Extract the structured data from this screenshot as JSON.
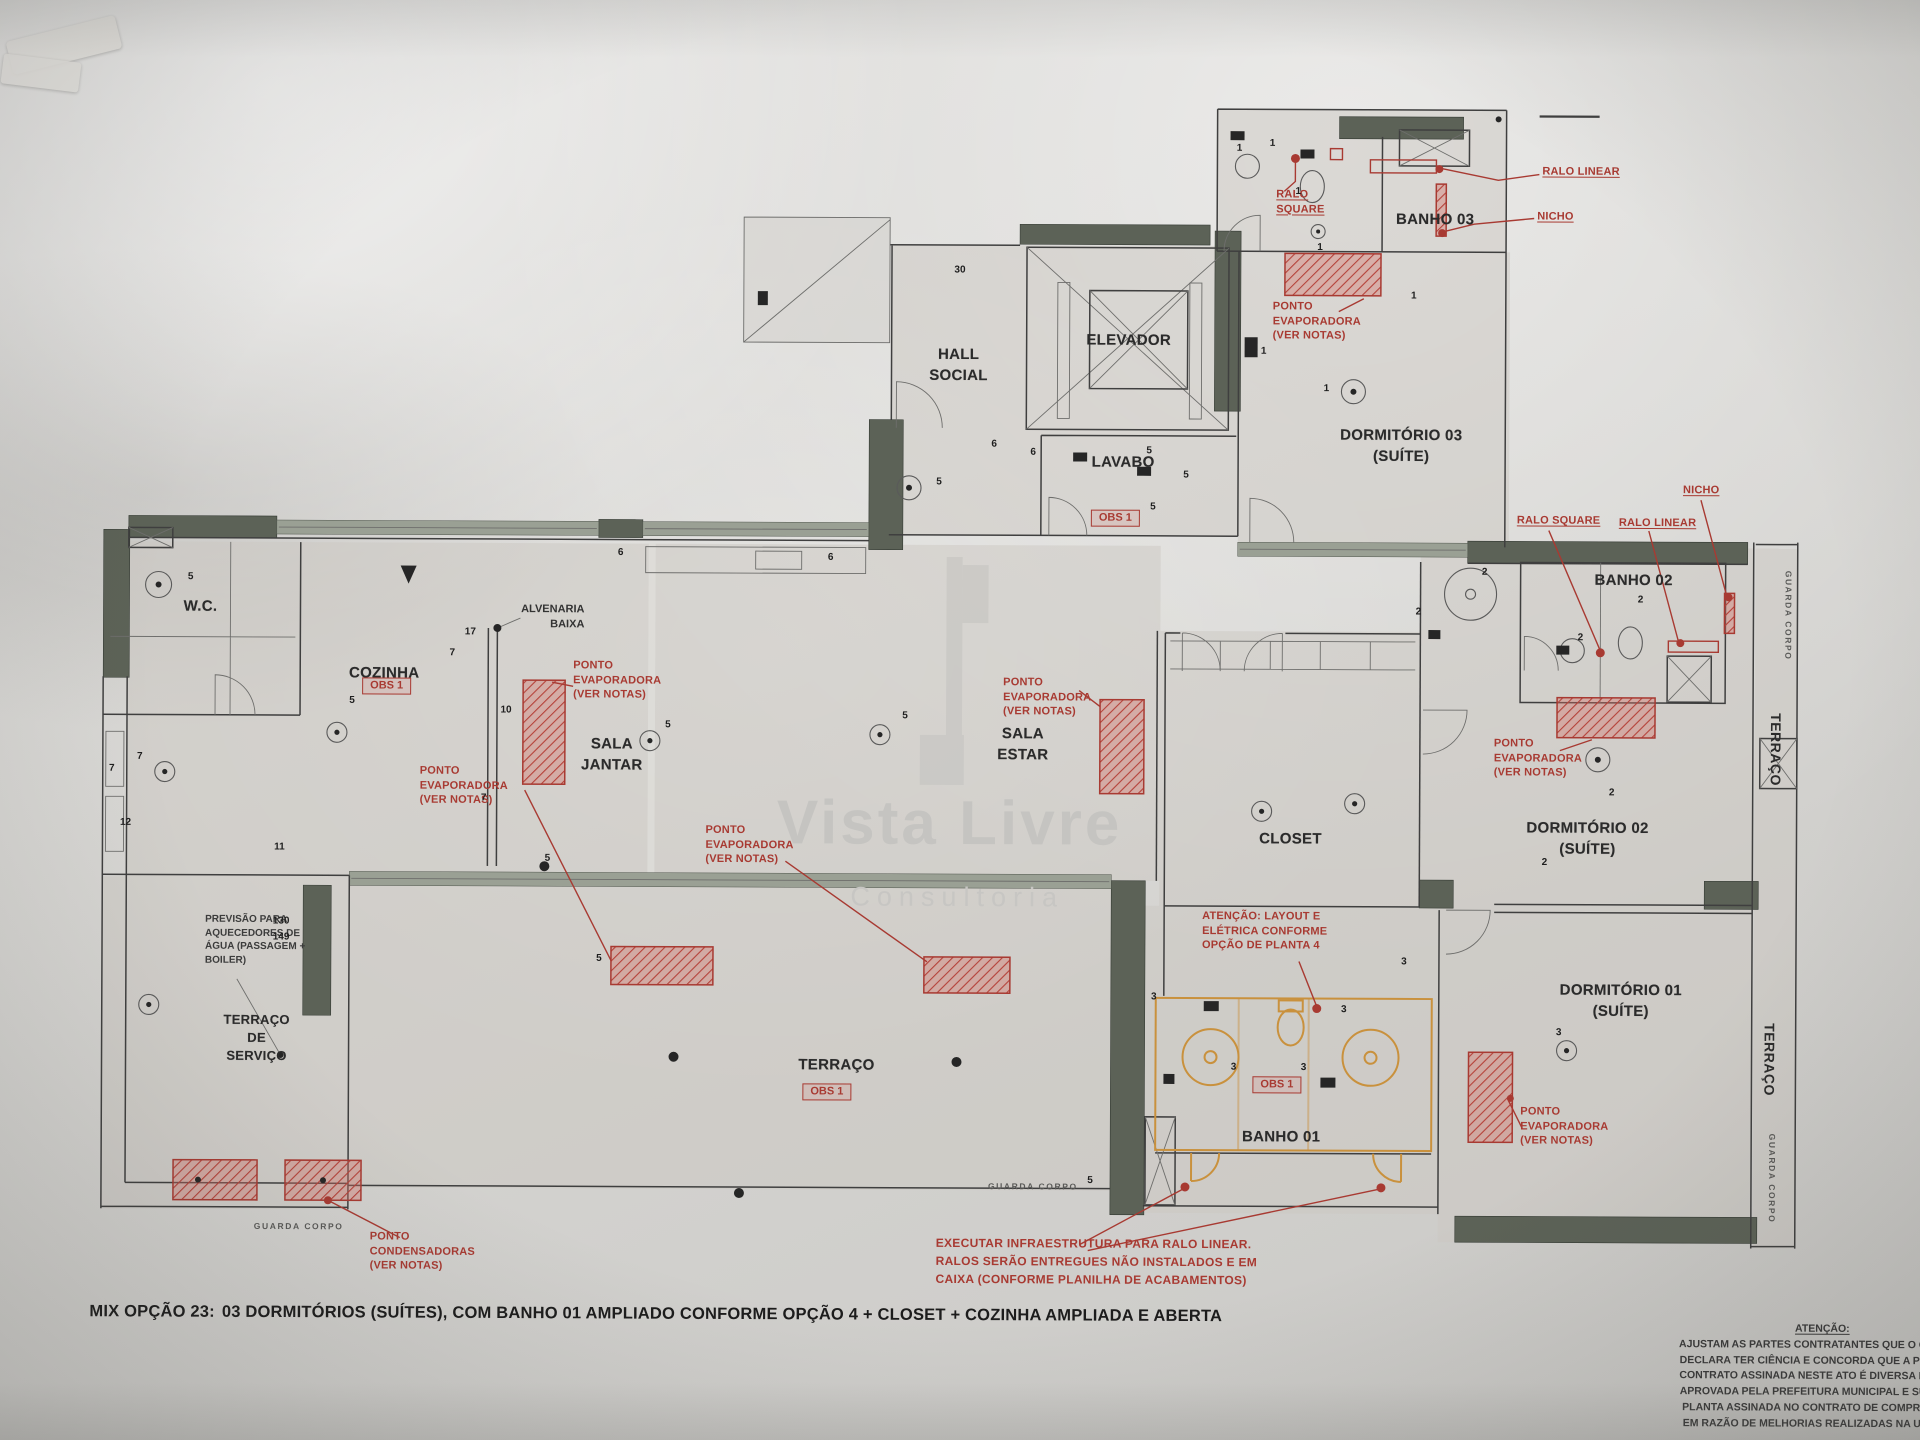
{
  "watermark": {
    "title": "Vista Livre",
    "subtitle": "Consultoria"
  },
  "rooms": {
    "elevador": "ELEVADOR",
    "hall_social": "HALL\nSOCIAL",
    "lavabo": "LAVABO",
    "banho03": "BANHO 03",
    "dormitorio03": "DORMITÓRIO 03\n(SUÍTE)",
    "banho02": "BANHO 02",
    "dormitorio02": "DORMITÓRIO 02\n(SUÍTE)",
    "closet": "CLOSET",
    "sala_estar": "SALA\nESTAR",
    "sala_jantar": "SALA\nJANTAR",
    "cozinha": "COZINHA",
    "wc": "W.C.",
    "terraco_servico": "TERRAÇO\nDE\nSERVIÇO",
    "terraco": "TERRAÇO",
    "banho01": "BANHO 01",
    "dormitorio01": "DORMITÓRIO 01\n(SUÍTE)",
    "terraco_lateral_superior": "TERRAÇO",
    "terraco_lateral_inferior": "TERRAÇO"
  },
  "annotations": {
    "ralo_linear": "RALO LINEAR",
    "nicho": "NICHO",
    "ralo_square": "RALO\nSQUARE",
    "ralo_square_inline": "RALO SQUARE",
    "ponto_evaporadora": "PONTO\nEVAPORADORA\n(VER NOTAS)",
    "ponto_condensadoras": "PONTO\nCONDENSADORAS\n(VER NOTAS)",
    "obs1": "OBS 1",
    "alvenaria_baixa": "ALVENARIA\nBAIXA",
    "previsao": "PREVISÃO PARA\nAQUECEDORES DE\nÁGUA (PASSAGEM +\nBOILER)",
    "atencao_layout": "ATENÇÃO: LAYOUT E\nELÉTRICA CONFORME\nOPÇÃO DE PLANTA 4",
    "executar_ralo": "EXECUTAR INFRAESTRUTURA PARA RALO LINEAR.\nRALOS SERÃO ENTREGUES NÃO INSTALADOS E EM\nCAIXA (CONFORME PLANILHA DE ACABAMENTOS)",
    "guarda_corpo": "GUARDA CORPO"
  },
  "caption": {
    "prefix": "MIX OPÇÃO 23:",
    "text": "03 DORMITÓRIOS (SUÍTES), COM BANHO 01 AMPLIADO CONFORME OPÇÃO 4 + CLOSET + COZINHA AMPLIADA E ABERTA"
  },
  "legal": {
    "title": "ATENÇÃO:",
    "lines": [
      "AJUSTAM AS PARTES CONTRATANTES QUE O COMPRA",
      "DECLARA TER CIÊNCIA E CONCORDA QUE A PLANTA D",
      "CONTRATO ASSINADA NESTE ATO É DIVERSA DA PLAN",
      "APROVADA PELA PREFEITURA MUNICIPAL E SUBSTITU",
      "PLANTA ASSINADA NO CONTRATO DE COMPRA E VEN",
      "EM RAZÃO DE MELHORIAS REALIZADAS NA UNIDADE"
    ]
  },
  "colors": {
    "annotation_red": "#a83a32",
    "fixture_orange": "#c9913d",
    "wall_dark": "#5c6257",
    "ink": "#2d2d2d"
  },
  "markers": [
    {
      "t": "5",
      "x": 190,
      "y": 580
    },
    {
      "t": "7",
      "x": 140,
      "y": 760
    },
    {
      "t": "7",
      "x": 112,
      "y": 772
    },
    {
      "t": "17",
      "x": 470,
      "y": 634
    },
    {
      "t": "7",
      "x": 452,
      "y": 655
    },
    {
      "t": "10",
      "x": 506,
      "y": 712
    },
    {
      "t": "5",
      "x": 352,
      "y": 703
    },
    {
      "t": "5",
      "x": 668,
      "y": 726
    },
    {
      "t": "5",
      "x": 905,
      "y": 716
    },
    {
      "t": "5",
      "x": 938,
      "y": 482
    },
    {
      "t": "6",
      "x": 993,
      "y": 444
    },
    {
      "t": "6",
      "x": 1032,
      "y": 452
    },
    {
      "t": "5",
      "x": 1148,
      "y": 450
    },
    {
      "t": "5",
      "x": 1185,
      "y": 474
    },
    {
      "t": "5",
      "x": 1152,
      "y": 506
    },
    {
      "t": "1",
      "x": 1237,
      "y": 147
    },
    {
      "t": "1",
      "x": 1270,
      "y": 142
    },
    {
      "t": "1",
      "x": 1296,
      "y": 190
    },
    {
      "t": "1",
      "x": 1318,
      "y": 246
    },
    {
      "t": "1",
      "x": 1412,
      "y": 294
    },
    {
      "t": "1",
      "x": 1325,
      "y": 387
    },
    {
      "t": "1",
      "x": 1262,
      "y": 350
    },
    {
      "t": "2",
      "x": 1418,
      "y": 610
    },
    {
      "t": "2",
      "x": 1484,
      "y": 570
    },
    {
      "t": "2",
      "x": 1640,
      "y": 597
    },
    {
      "t": "2",
      "x": 1580,
      "y": 635
    },
    {
      "t": "2",
      "x": 1612,
      "y": 790
    },
    {
      "t": "2",
      "x": 1545,
      "y": 860
    },
    {
      "t": "3",
      "x": 1155,
      "y": 996
    },
    {
      "t": "3",
      "x": 1235,
      "y": 1066
    },
    {
      "t": "3",
      "x": 1305,
      "y": 1066
    },
    {
      "t": "3",
      "x": 1345,
      "y": 1008
    },
    {
      "t": "3",
      "x": 1405,
      "y": 960
    },
    {
      "t": "3",
      "x": 1560,
      "y": 1030
    },
    {
      "t": "130",
      "x": 282,
      "y": 924
    },
    {
      "t": "149",
      "x": 282,
      "y": 940
    },
    {
      "t": "11",
      "x": 280,
      "y": 850
    },
    {
      "t": "12",
      "x": 126,
      "y": 826
    },
    {
      "t": "5",
      "x": 548,
      "y": 860
    },
    {
      "t": "5",
      "x": 600,
      "y": 960
    },
    {
      "t": "30",
      "x": 958,
      "y": 270
    },
    {
      "t": "6",
      "x": 620,
      "y": 554
    },
    {
      "t": "6",
      "x": 830,
      "y": 558
    },
    {
      "t": "7",
      "x": 484,
      "y": 800
    },
    {
      "t": "5",
      "x": 1092,
      "y": 1180
    }
  ]
}
